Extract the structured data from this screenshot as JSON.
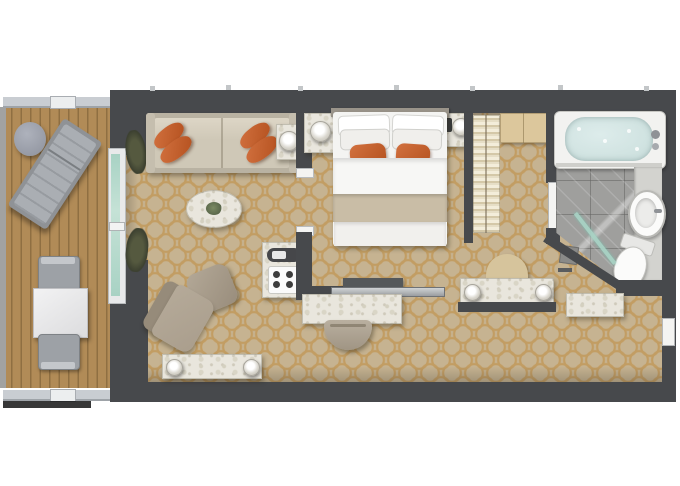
{
  "image": {
    "kind": "floor-plan-rendering",
    "subject": "Top-down 3D floor plan of a suite with private balcony",
    "width_px": 680,
    "height_px": 486,
    "background": "#ffffff",
    "visible_text": []
  },
  "palette": {
    "wall": "#47494c",
    "carpet": "#c6b391",
    "carpetLine": "#c08f45",
    "deck": "#b18b57",
    "deckLine": "#8f6f42",
    "railing": "#c9cdd2",
    "sofa": "#cfc8b7",
    "sofaBack": "#b9b2a2",
    "orange": "#d2713f",
    "orangeDark": "#b4511f",
    "marble": "#e9e6dd",
    "taupe": "#aa9e8d",
    "chairGray": "#9da1a6",
    "glass": "#a8d2c4",
    "water": "#cfe2e0",
    "bathFloor": "#9f9f9d",
    "counter": "#d3d3cf",
    "woodShelf": "#dcc79c",
    "clothesCream": "#eee6d0",
    "bedWhite": "#f4f4f2",
    "bedRunner": "#c9bda6"
  },
  "rooms": {
    "balcony": {
      "label": "Balcony",
      "floor": "wood deck",
      "furniture": [
        "sun lounger",
        "round side table",
        "square dining table",
        "two chairs",
        "railing"
      ]
    },
    "living_room": {
      "label": "Living room",
      "floor": "patterned carpet",
      "furniture": [
        "three-seat sofa with four orange pillows",
        "side table with lamp",
        "oval marble coffee table with plant",
        "armchair",
        "ottoman",
        "minibar coffee cabinet",
        "low bench with two lamps",
        "two plants at balcony door"
      ]
    },
    "bedroom": {
      "label": "Bedroom",
      "floor": "patterned carpet",
      "furniture": [
        "king bed with four white and two orange pillows",
        "left nightstand with lamp",
        "right nightstand with lamp and phone",
        "TV console",
        "marble desk",
        "desk chair"
      ]
    },
    "closet": {
      "label": "Walk-in closet",
      "furniture": [
        "hanging clothes rail",
        "wooden shelf cabinet"
      ]
    },
    "dressing": {
      "label": "Dressing area",
      "furniture": [
        "vanity console with two lamps",
        "semicircular stool"
      ]
    },
    "corridor": {
      "label": "Entry corridor",
      "furniture": [
        "marble entry console",
        "entry door"
      ]
    },
    "bathroom": {
      "label": "Bathroom",
      "floor": "gray marble tile",
      "furniture": [
        "bathtub with water",
        "tub faucet",
        "vanity counter",
        "oval sink",
        "toilet",
        "glass shower screen",
        "shower drain",
        "bathroom door"
      ]
    }
  },
  "doors": {
    "balcony_glass_door": "sliding glass door between balcony and living room",
    "partition_opening": "opening between living room and bedroom",
    "bathroom_door": "door between closet hallway and bathroom",
    "entry_door": "suite entry door on right wall"
  }
}
